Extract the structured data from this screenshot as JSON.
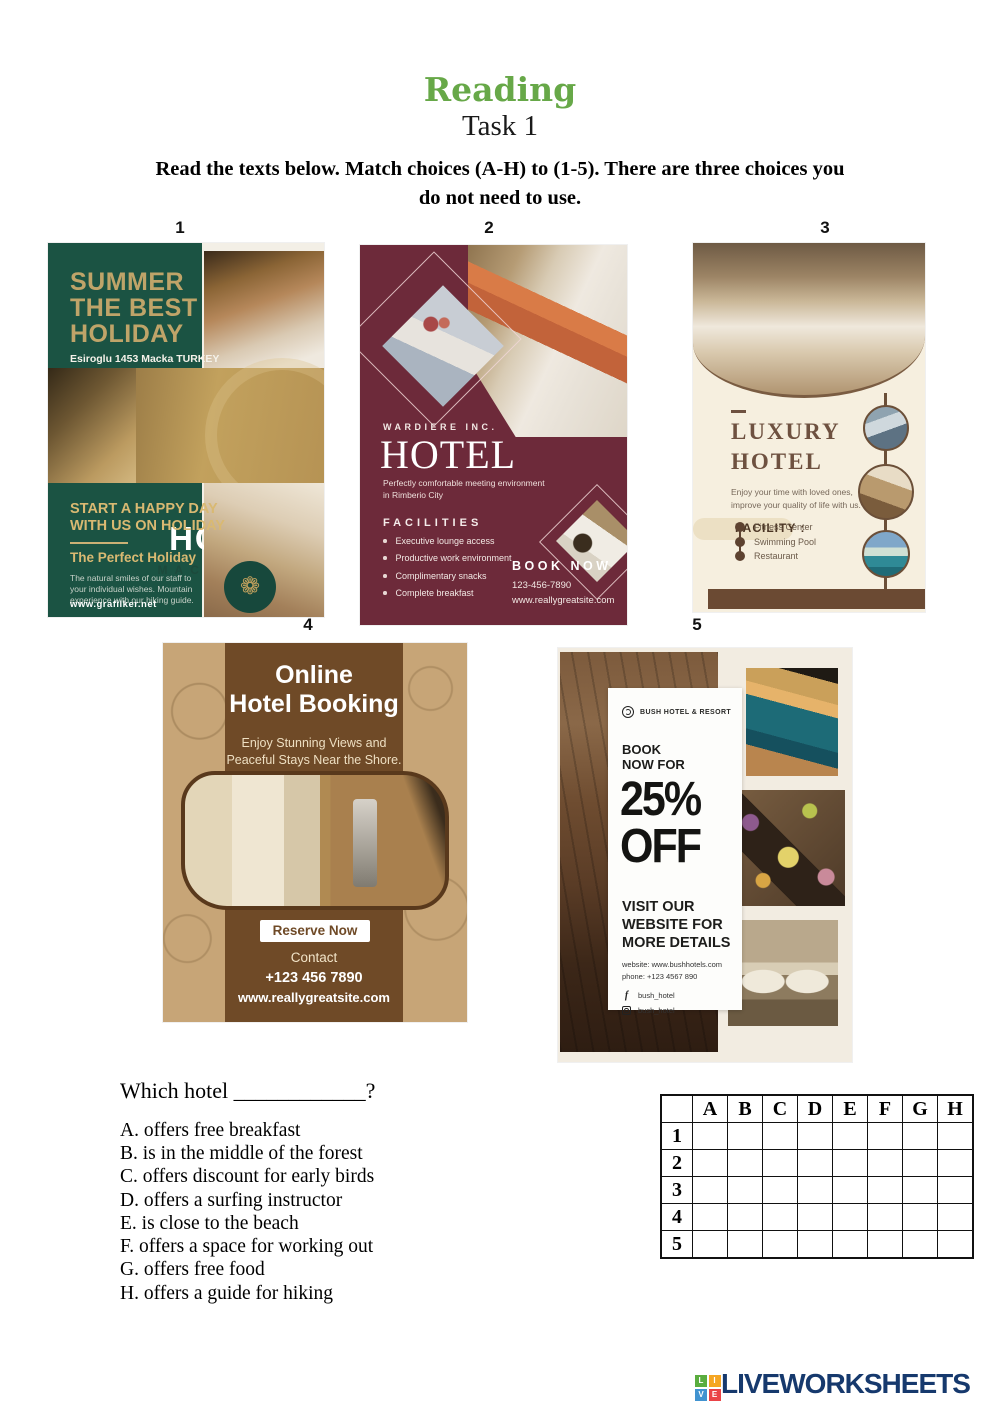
{
  "header": {
    "title": "Reading",
    "task": "Task 1",
    "instructions": [
      "Read the texts below. Match choices (A-H) to (1-5). There are three choices you",
      "do not need to use."
    ]
  },
  "flyer_labels": [
    "1",
    "2",
    "3",
    "4",
    "5"
  ],
  "flyer1": {
    "headline": [
      "SUMMER",
      "THE BEST",
      "HOLIDAY"
    ],
    "address": "Esiroglu 1453 Macka TURKEY",
    "name": "HOTEL",
    "subname": "MACKA SUIT",
    "slogan": [
      "START A HAPPY DAY",
      "WITH US ON HOLIDAY"
    ],
    "subhead": "The Perfect Holiday",
    "body": [
      "The natural smiles of our staff to",
      "your individual wishes. Mountain",
      "experience with our hiking guide."
    ],
    "website": "www.grafilker.net",
    "badge_icon": "❁"
  },
  "flyer2": {
    "company": "WARDIERE INC.",
    "name": "HOTEL",
    "tagline": [
      "Perfectly comfortable meeting environment",
      "in Rimberio City"
    ],
    "facilities_title": "FACILITIES",
    "facilities": [
      "Executive lounge access",
      "Productive work environment",
      "Complimentary snacks",
      "Complete breakfast"
    ],
    "book_now": "BOOK NOW",
    "phone": "123-456-7890",
    "website": "www.reallygreatsite.com"
  },
  "flyer3": {
    "name": [
      "LUXURY",
      "HOTEL"
    ],
    "tagline": [
      "Enjoy your time with loved ones,",
      "improve your quality of life with us."
    ],
    "facility_title": "FACILITY :",
    "facilities": [
      "Fitness Center",
      "Swimming Pool",
      "Restaurant"
    ]
  },
  "flyer4": {
    "title": [
      "Online",
      "Hotel Booking"
    ],
    "subtitle": [
      "Enjoy Stunning Views and",
      "Peaceful Stays Near the Shore."
    ],
    "button": "Reserve Now",
    "contact_label": "Contact",
    "phone": "+123 456 7890",
    "website": "www.reallygreatsite.com"
  },
  "flyer5": {
    "brand": "BUSH HOTEL & RESORT",
    "book": [
      "BOOK",
      "NOW FOR"
    ],
    "discount": [
      "25%",
      "OFF"
    ],
    "visit": [
      "VISIT OUR",
      "WEBSITE FOR",
      "MORE DETAILS"
    ],
    "website": "website: www.bushhotels.com",
    "phone": "phone: +123 4567 890",
    "facebook": "bush_hotel",
    "instagram": "bush_hotel"
  },
  "question": {
    "text": "Which hotel ____________?",
    "choices": [
      "A. offers free breakfast",
      "B. is in the middle of the forest",
      "C. offers discount for early birds",
      "D. offers a surfing instructor",
      "E. is close to the beach",
      "F. offers a space for working out",
      "G. offers free food",
      "H. offers a guide for hiking"
    ]
  },
  "answer_grid": {
    "columns": [
      "A",
      "B",
      "C",
      "D",
      "E",
      "F",
      "G",
      "H"
    ],
    "rows": [
      "1",
      "2",
      "3",
      "4",
      "5"
    ]
  },
  "footer": {
    "logo_squares": [
      "L",
      "I",
      "V",
      "E"
    ],
    "logo_text": "LIVEWORKSHEETS"
  },
  "colors": {
    "title_green": "#67a848",
    "flyer1_green": "#1b5343",
    "flyer1_gold": "#c2a15d",
    "flyer2_maroon": "#6d2a3a",
    "flyer3_cream": "#f6efdf",
    "flyer3_brown": "#6b4a33",
    "flyer4_tan": "#c7a577",
    "flyer4_brown": "#6f4a27",
    "flyer5_cream": "#f2ece1",
    "logo_navy": "#16396d",
    "logo_square_colors": [
      "#5aad3f",
      "#f5a623",
      "#4193d0",
      "#ea4347"
    ]
  }
}
